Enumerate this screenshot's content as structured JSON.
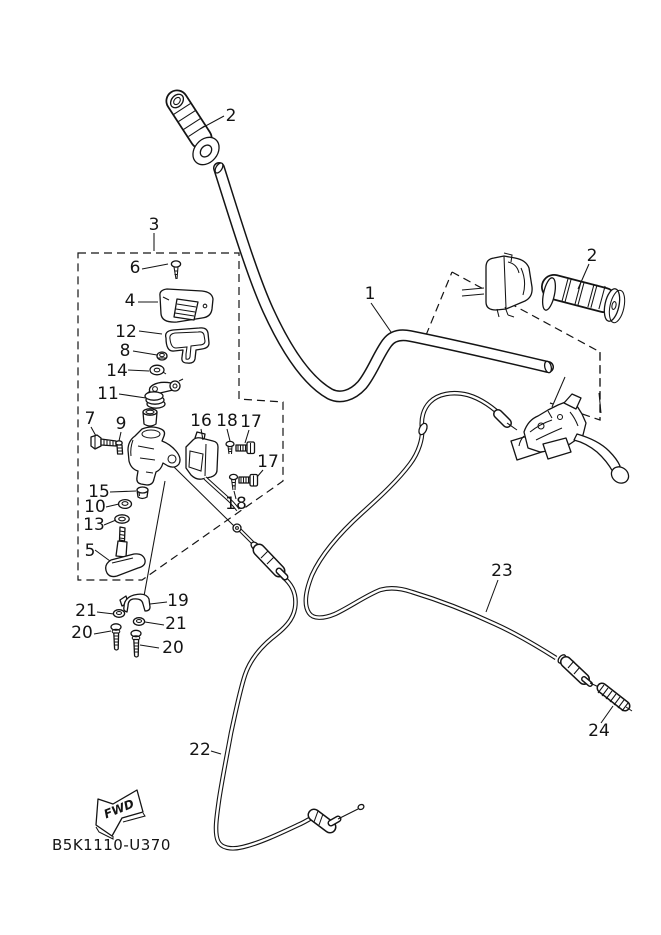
{
  "figure": {
    "type": "exploded-parts-diagram",
    "background": "#ffffff",
    "line_color": "#141414",
    "drawing_code": "B5K1110-U370",
    "direction_label": "FWD",
    "callouts": [
      {
        "id": "grip-left",
        "text": "2"
      },
      {
        "id": "detail-box",
        "text": "3"
      },
      {
        "id": "cover-screw",
        "text": "6"
      },
      {
        "id": "housing-top",
        "text": "4"
      },
      {
        "id": "gasket",
        "text": "12"
      },
      {
        "id": "nut",
        "text": "8"
      },
      {
        "id": "tab-washer",
        "text": "14"
      },
      {
        "id": "coil-spring",
        "text": "11"
      },
      {
        "id": "clamp-bolt",
        "text": "7"
      },
      {
        "id": "pin-screw",
        "text": "9"
      },
      {
        "id": "housing-lower",
        "text": "16"
      },
      {
        "id": "screw-upper",
        "text": "18"
      },
      {
        "id": "bolt-upper",
        "text": "17"
      },
      {
        "id": "bolt-lower",
        "text": "17"
      },
      {
        "id": "pivot-cap",
        "text": "15"
      },
      {
        "id": "washer-upper",
        "text": "10"
      },
      {
        "id": "washer-lower",
        "text": "13"
      },
      {
        "id": "screw-lower",
        "text": "18"
      },
      {
        "id": "lever-knob",
        "text": "5"
      },
      {
        "id": "cable-clamp",
        "text": "19"
      },
      {
        "id": "spring-washer-left",
        "text": "21"
      },
      {
        "id": "spring-washer-right",
        "text": "21"
      },
      {
        "id": "clamp-screw-left",
        "text": "20"
      },
      {
        "id": "clamp-screw-right",
        "text": "20"
      },
      {
        "id": "handlebar",
        "text": "1"
      },
      {
        "id": "grip-right",
        "text": "2"
      },
      {
        "id": "cable-rear",
        "text": "23"
      },
      {
        "id": "cable-end-spring",
        "text": "24"
      },
      {
        "id": "cable-front",
        "text": "22"
      }
    ]
  }
}
